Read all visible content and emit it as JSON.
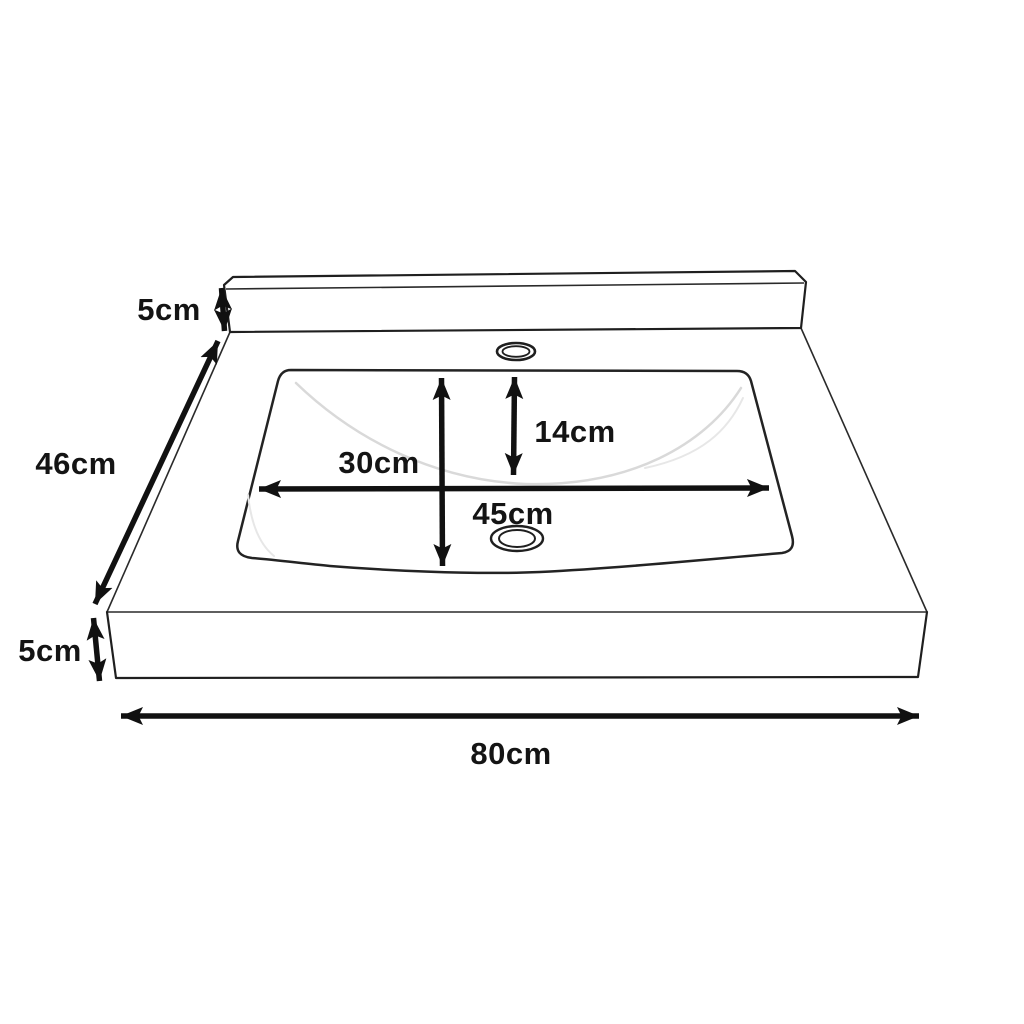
{
  "diagram": {
    "object": "washbasin-countertop-dimension-drawing",
    "unit": "cm",
    "colors": {
      "background": "#ffffff",
      "line": "#1f1f1f",
      "arrow": "#111111",
      "shading": "#d9d9d9"
    },
    "dimensions": {
      "backsplash_height": "5cm",
      "overall_depth": "46cm",
      "counter_thickness": "5cm",
      "overall_width": "80cm",
      "basin_depth": "30cm",
      "basin_inner_height": "14cm",
      "basin_width": "45cm"
    }
  }
}
